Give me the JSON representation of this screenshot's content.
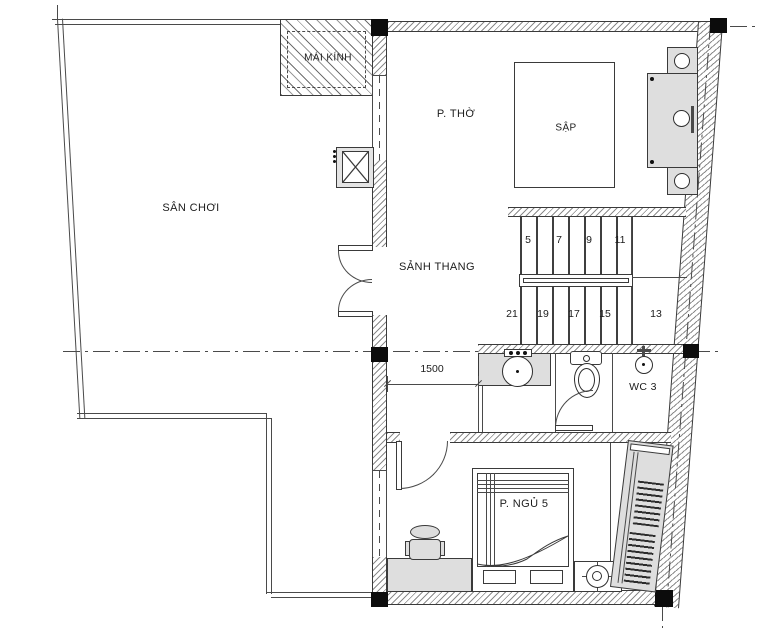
{
  "drawing_title": "Floor plan - upper storey",
  "rooms": {
    "san_choi": "SÂN CHƠI",
    "mai_kinh": "MÁI KÍNH",
    "p_tho": "P. THỜ",
    "sap": "SẬP",
    "sanh_thang": "SẢNH THANG",
    "wc3": "WC 3",
    "p_ngu5": "P. NGỦ 5"
  },
  "stairs": {
    "up": [
      "5",
      "7",
      "9",
      "11"
    ],
    "down": [
      "21",
      "19",
      "17",
      "15",
      "13"
    ]
  },
  "dimensions": {
    "sanh_thang_width": "1500"
  },
  "colors": {
    "line": "#3a3a3a",
    "furniture_fill": "#dedede",
    "column_fill": "#0c0c0c",
    "background": "#ffffff"
  }
}
